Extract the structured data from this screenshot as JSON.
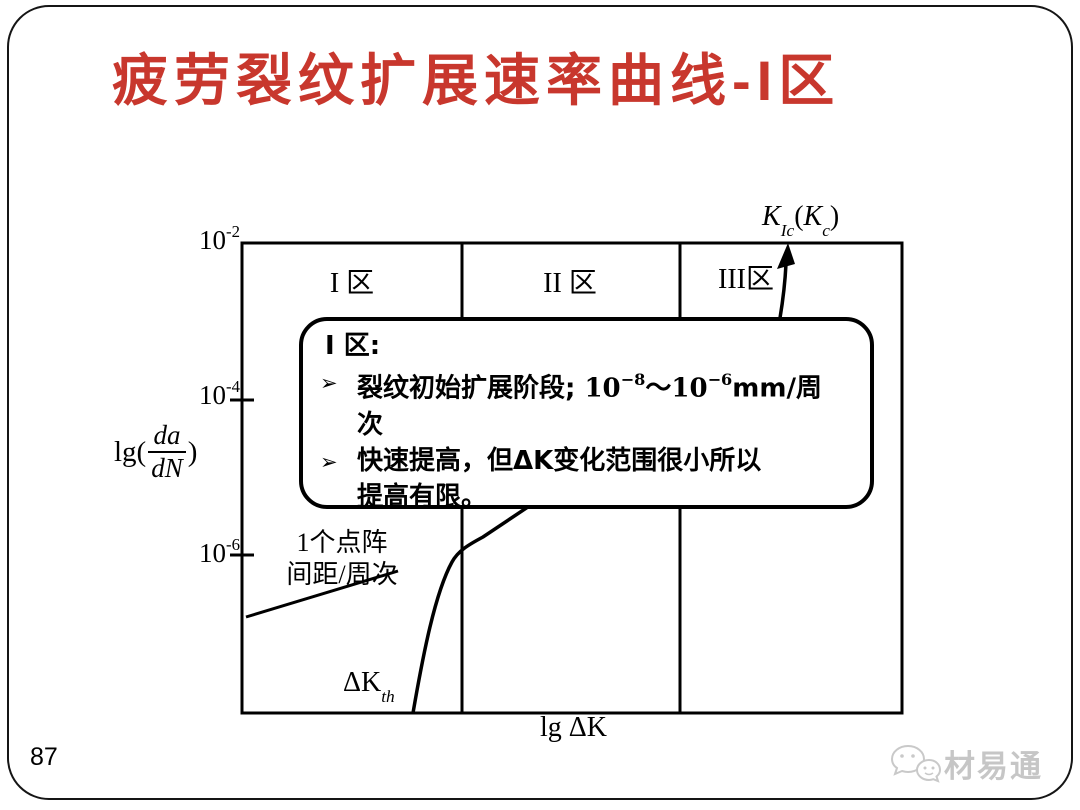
{
  "slide": {
    "title": "疲劳裂纹扩展速率曲线-I区",
    "page_number": "87",
    "watermark_label": "材易通"
  },
  "colors": {
    "title_red": "#c8372d",
    "line_black": "#000000",
    "watermark_gray": "#c6c6c6"
  },
  "chart": {
    "y_ticks": [
      {
        "base": "10",
        "exp": "-2"
      },
      {
        "base": "10",
        "exp": "-4"
      },
      {
        "base": "10",
        "exp": "-6"
      }
    ],
    "y_axis": {
      "prefix": "lg(",
      "frac_num": "da",
      "frac_den": "dN",
      "suffix": ")"
    },
    "x_axis_label": "lg ΔK",
    "regions": [
      {
        "label": "I 区"
      },
      {
        "label": "II 区"
      },
      {
        "label": "III区"
      }
    ],
    "kic": {
      "k1": "K",
      "sub1": "Ic",
      "open": "(",
      "k2": "K",
      "sub2": "c",
      "close": ")"
    },
    "dkth": {
      "base": "ΔK",
      "sub": "th"
    },
    "lattice_note": {
      "line1": "1个点阵",
      "line2": "间距/周次"
    }
  },
  "callout": {
    "title": "I 区:",
    "bullet_marker": "➢",
    "b1": {
      "text": "裂纹初始扩展阶段; ",
      "n1": "10",
      "e1": "−8",
      "tilde": "～",
      "n2": "10",
      "e2": "−6",
      "unit": "mm/周",
      "wrap": "次"
    },
    "b2": {
      "line1": "快速提高，但ΔK变化范围很小所以",
      "line2": "提高有限。"
    }
  },
  "chart_data": {
    "type": "line",
    "title": "疲劳裂纹扩展速率曲线 (schematic, 三区划分)",
    "xlabel": "lg ΔK",
    "ylabel": "lg(da/dN)",
    "y_tick_values": [
      "1e-2",
      "1e-4",
      "1e-6"
    ],
    "y_scale": "log (mm/cycle), top of plot = 1e-2, one decade ≈ 78 px",
    "x_scale": "log, unlabeled (qualitative)",
    "region_boundaries_x_fraction": [
      0.333,
      0.664
    ],
    "region_labels": [
      "I 区",
      "II 区",
      "III区"
    ],
    "curve_points_fraction_of_plot": [
      [
        0.259,
        0.0
      ],
      [
        0.268,
        0.13
      ],
      [
        0.285,
        0.26
      ],
      [
        0.305,
        0.315
      ],
      [
        0.33,
        0.345
      ],
      [
        0.37,
        0.375
      ],
      [
        0.45,
        0.44
      ],
      [
        0.56,
        0.52
      ],
      [
        0.67,
        0.61
      ],
      [
        0.76,
        0.7
      ],
      [
        0.805,
        0.79
      ],
      [
        0.818,
        0.9
      ],
      [
        0.827,
        1.0
      ]
    ],
    "annotations": [
      {
        "label": "ΔK_th",
        "meaning": "threshold where curve meets x-axis",
        "x_fraction": 0.26
      },
      {
        "label": "K_Ic(K_c)",
        "meaning": "fracture toughness, arrow at top of region III",
        "x_fraction": 0.83
      },
      {
        "label": "1个点阵间距/周次",
        "meaning": "one lattice spacing per cycle level, leader line from y-axis near 10^-6.8"
      }
    ],
    "legend": "none",
    "grid": "off"
  }
}
